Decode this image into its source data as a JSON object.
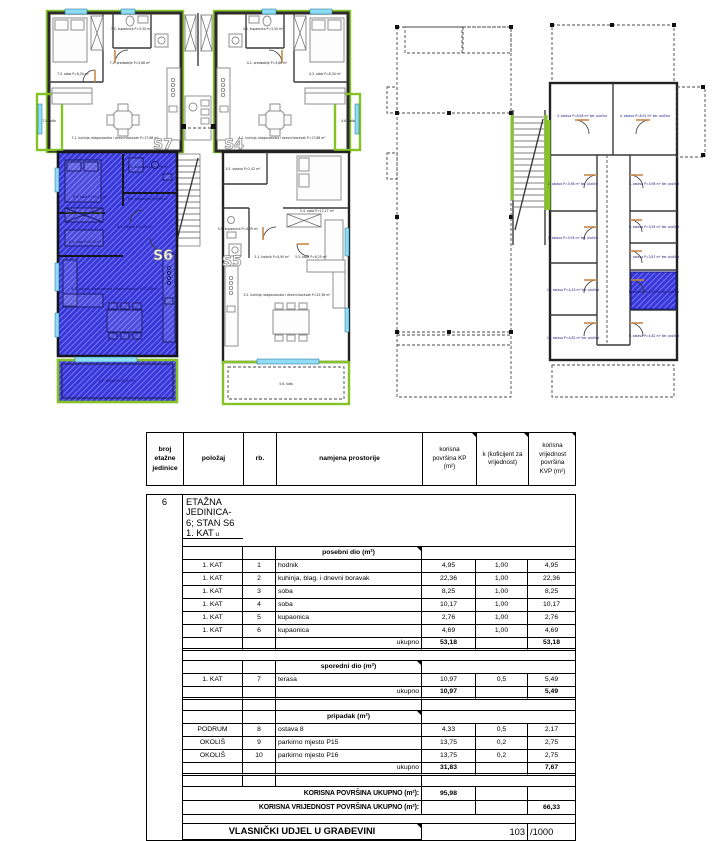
{
  "plans": {
    "colors": {
      "highlight_blue": "#3636d8",
      "outline_green": "#84c226",
      "window_cyan": "#8edcf5"
    },
    "left": {
      "s7": "S7",
      "s4": "S4",
      "s5": "S5",
      "s6": "S6",
      "rooms": [
        "7.3. soba P=8,34 m²",
        "7.4. kupaonica P=3,34 m²",
        "7.2. predsoblje P=3,88 m²",
        "7.1. kuhinja, blagovaonica i dnevni boravak P=17,86 m²",
        "7.5. lođa",
        "4.3. soba P=8,34 m²",
        "4.4. kupaonica P=3,34 m²",
        "4.2. predsoblje P=3,88 m²",
        "4.1. kuhinja, blagovaonica i dnevni boravak P=17,86 m²",
        "4.6. lođa",
        "6.4. soba P=10,17 m²",
        "6.3. soba P=8,25 m²",
        "6.5. kupaonica P=2,76 m²",
        "6.6. kupaonica P=4,69 m²",
        "6.1. hodnik P=4,95 m²",
        "6.2. kuhinja, blagovaonica i dnevni boravak P=22,36 m²",
        "6.7. terasa P=10,97 m²",
        "4.5. ostava P=2,02 m²",
        "5.4. soba P=12,17 m²",
        "5.5. kupaonica P=4,09 m²",
        "5.1. hodnik P=4,90 m²",
        "5.3. soba P=8,25 m²",
        "5.2. kuhinja, blagovaonica i dnevni boravak P=22,36 m²",
        "5.6. lođa"
      ]
    },
    "right": {
      "rooms": [
        "1. ostava P=3,94 m² ker. pločice",
        "2. ostava P=3,98 m² ker. pločice",
        "3. ostava P=8,58 m² ker. pločice",
        "4. ostava P=8,91 m² ker. pločice",
        "5. ostava P=3,98 m² ker. pločice",
        "6. ostava P=3,94 m² ker. pločice",
        "7. ostava P=3,87 m² ker. pločice",
        "8. ostava P=4,33 m² ker. pločice",
        "9. ostava P=4,82 m² ker. pločice",
        "10. ostava P=4,82 m² ker. pločice",
        "11. ostava P=4,33 m² ker. pločice"
      ]
    }
  },
  "table": {
    "header": {
      "c1": "broj\netažne\njedinice",
      "c2": "položaj",
      "c3": "rb.",
      "c4": "namjena prostorije",
      "c5": "korisna\npovršina KP\n(m²)",
      "c6": "k (koficijent za\nvrijednost)",
      "c7": "korisna\nvrijednost\npovršina\nKVP (m²)"
    },
    "block": {
      "unit_no": "6",
      "title": "ETAŽNA JEDINICA- 6; STAN S6 1. KAT",
      "subtitle": " u etažnom elaboratu označen TAMNOPLAVOM bojom. Vlasništvo:"
    },
    "ukupno_label": "ukupno",
    "sections": [
      {
        "title": "posebni dio (m²)",
        "rows": [
          {
            "pos": "1. KAT",
            "rb": "1",
            "name": "hodnik",
            "kp": "4,95",
            "k": "1,00",
            "kvp": "4,95"
          },
          {
            "pos": "1. KAT",
            "rb": "2",
            "name": "kuhinja, blag. i dnevni boravak",
            "kp": "22,36",
            "k": "1,00",
            "kvp": "22,36"
          },
          {
            "pos": "1. KAT",
            "rb": "3",
            "name": "soba",
            "kp": "8,25",
            "k": "1,00",
            "kvp": "8,25"
          },
          {
            "pos": "1. KAT",
            "rb": "4",
            "name": "soba",
            "kp": "10,17",
            "k": "1,00",
            "kvp": "10,17"
          },
          {
            "pos": "1. KAT",
            "rb": "5",
            "name": "kupaonica",
            "kp": "2,76",
            "k": "1,00",
            "kvp": "2,76"
          },
          {
            "pos": "1. KAT",
            "rb": "6",
            "name": "kupaonica",
            "kp": "4,69",
            "k": "1,00",
            "kvp": "4,69"
          }
        ],
        "total_kp": "53,18",
        "total_kvp": "53,18"
      },
      {
        "title": "sporedni dio (m²)",
        "rows": [
          {
            "pos": "1. KAT",
            "rb": "7",
            "name": "terasa",
            "kp": "10,97",
            "k": "0,5",
            "kvp": "5,49"
          }
        ],
        "total_kp": "10,97",
        "total_kvp": "5,49"
      },
      {
        "title": "pripadak (m²)",
        "rows": [
          {
            "pos": "PODRUM",
            "rb": "8",
            "name": "ostava 8",
            "kp": "4,33",
            "k": "0,5",
            "kvp": "2,17"
          },
          {
            "pos": "OKOLIŠ",
            "rb": "9",
            "name": "parkirno mjesto P15",
            "kp": "13,75",
            "k": "0,2",
            "kvp": "2,75"
          },
          {
            "pos": "OKOLIŠ",
            "rb": "10",
            "name": "parkirno mjesto P16",
            "kp": "13,75",
            "k": "0,2",
            "kvp": "2,75"
          }
        ],
        "total_kp": "31,83",
        "total_kvp": "7,67"
      }
    ],
    "summary": {
      "kp_label": "KORISNA POVRŠINA UKUPNO (m²):",
      "kp_value": "95,98",
      "kvp_label": "KORISNA VRIJEDNOST POVRŠINA UKUPNO (m²):",
      "kvp_value": "66,33",
      "share_label": "VLASNIČKI UDJEL U GRAĐEVINI",
      "share_value": "103",
      "share_denom": "/1000"
    }
  }
}
